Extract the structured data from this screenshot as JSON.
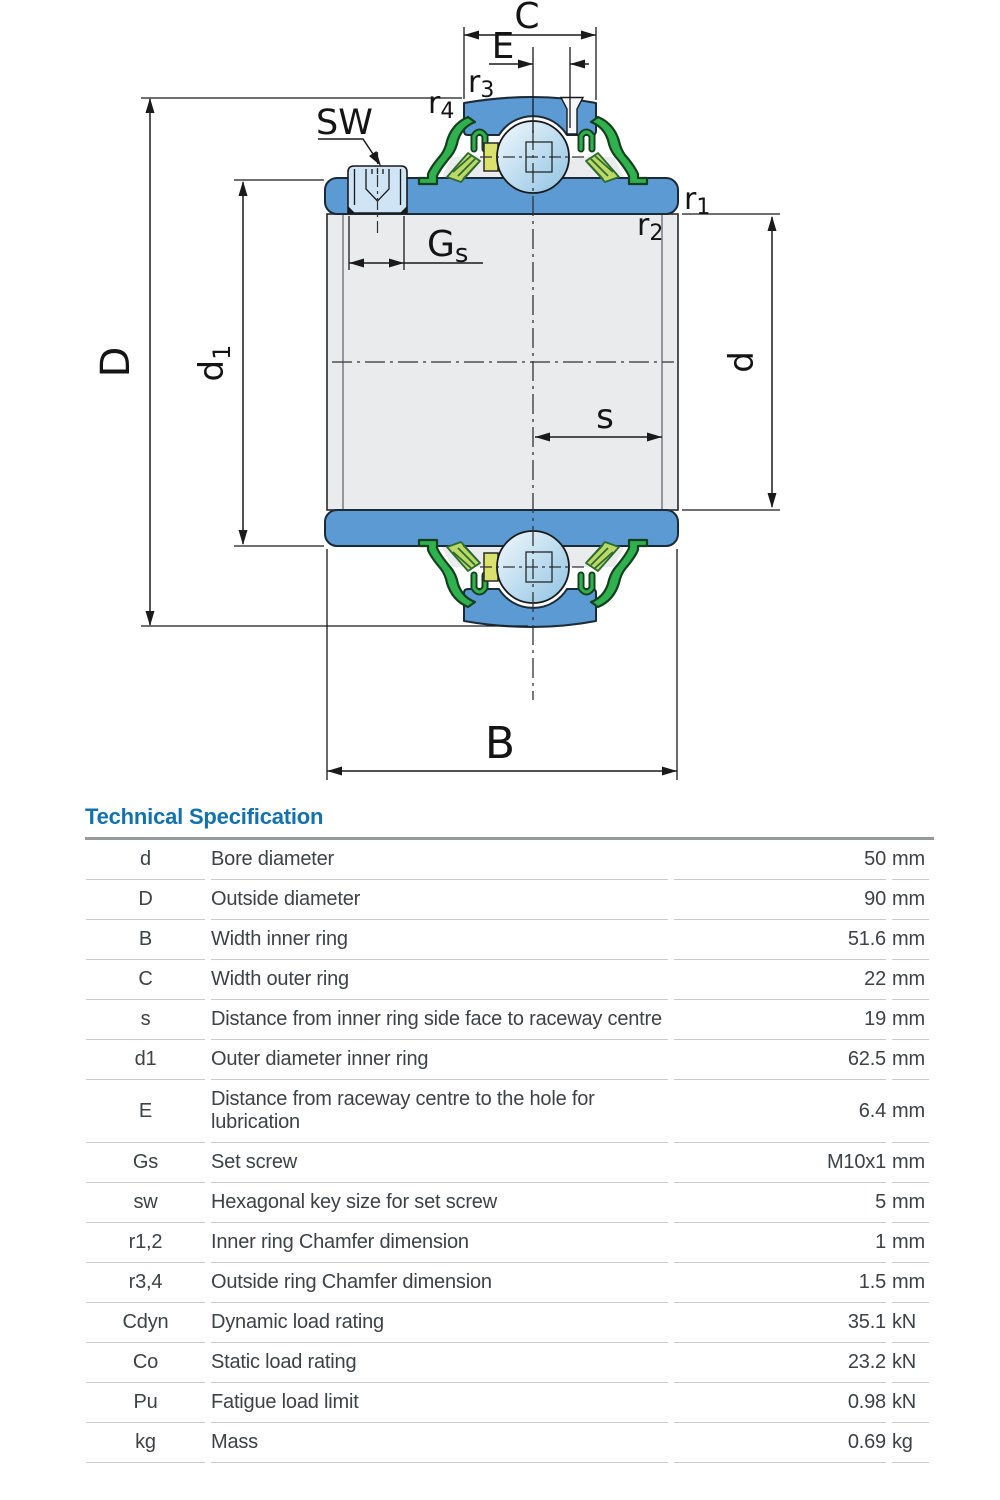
{
  "drawing": {
    "labels": {
      "C": "C",
      "E": "E",
      "SW": "SW",
      "D": "D",
      "d": "d",
      "s": "s",
      "B": "B",
      "r1": {
        "base": "r",
        "sub": "1"
      },
      "r2": {
        "base": "r",
        "sub": "2"
      },
      "r3": {
        "base": "r",
        "sub": "3"
      },
      "r4": {
        "base": "r",
        "sub": "4"
      },
      "d1": {
        "base": "d",
        "sub": "1"
      },
      "Gs": {
        "base": "G",
        "sub": "s"
      }
    },
    "colors": {
      "ring_blue": "#5b9ad2",
      "steel_gray": "#e9ebec",
      "seal_green": "#2fb14d",
      "flinger_green": "#bcd966",
      "cage_yellow": "#dbe26b",
      "screw_blue": "#cfe4f5",
      "ball_light": "#f2f9fd",
      "ball_shade": "#8ec3e3",
      "notch_fill": "#f4f6f8",
      "title_blue": "#1371ad"
    }
  },
  "spec": {
    "title": "Technical Specification",
    "rows": [
      {
        "symbol": "d",
        "description": "Bore diameter",
        "value": "50",
        "unit": "mm"
      },
      {
        "symbol": "D",
        "description": "Outside diameter",
        "value": "90",
        "unit": "mm"
      },
      {
        "symbol": "B",
        "description": "Width inner ring",
        "value": "51.6",
        "unit": "mm"
      },
      {
        "symbol": "C",
        "description": "Width outer ring",
        "value": "22",
        "unit": "mm"
      },
      {
        "symbol": "s",
        "description": "Distance from inner ring side face to raceway centre",
        "value": "19",
        "unit": "mm"
      },
      {
        "symbol": "d1",
        "description": "Outer diameter inner ring",
        "value": "62.5",
        "unit": "mm"
      },
      {
        "symbol": "E",
        "description": "Distance from raceway centre to the hole for lubrication",
        "value": "6.4",
        "unit": "mm"
      },
      {
        "symbol": "Gs",
        "description": "Set screw",
        "value": "M10x1",
        "unit": "mm"
      },
      {
        "symbol": "sw",
        "description": "Hexagonal key size for set screw",
        "value": "5",
        "unit": "mm"
      },
      {
        "symbol": "r1,2",
        "description": "Inner ring Chamfer dimension",
        "value": "1",
        "unit": "mm"
      },
      {
        "symbol": "r3,4",
        "description": "Outside ring Chamfer dimension",
        "value": "1.5",
        "unit": "mm"
      },
      {
        "symbol": "Cdyn",
        "description": "Dynamic load rating",
        "value": "35.1",
        "unit": "kN"
      },
      {
        "symbol": "Co",
        "description": "Static load rating",
        "value": "23.2",
        "unit": "kN"
      },
      {
        "symbol": "Pu",
        "description": "Fatigue load limit",
        "value": "0.98",
        "unit": "kN"
      },
      {
        "symbol": "kg",
        "description": "Mass",
        "value": "0.69",
        "unit": "kg"
      }
    ]
  }
}
